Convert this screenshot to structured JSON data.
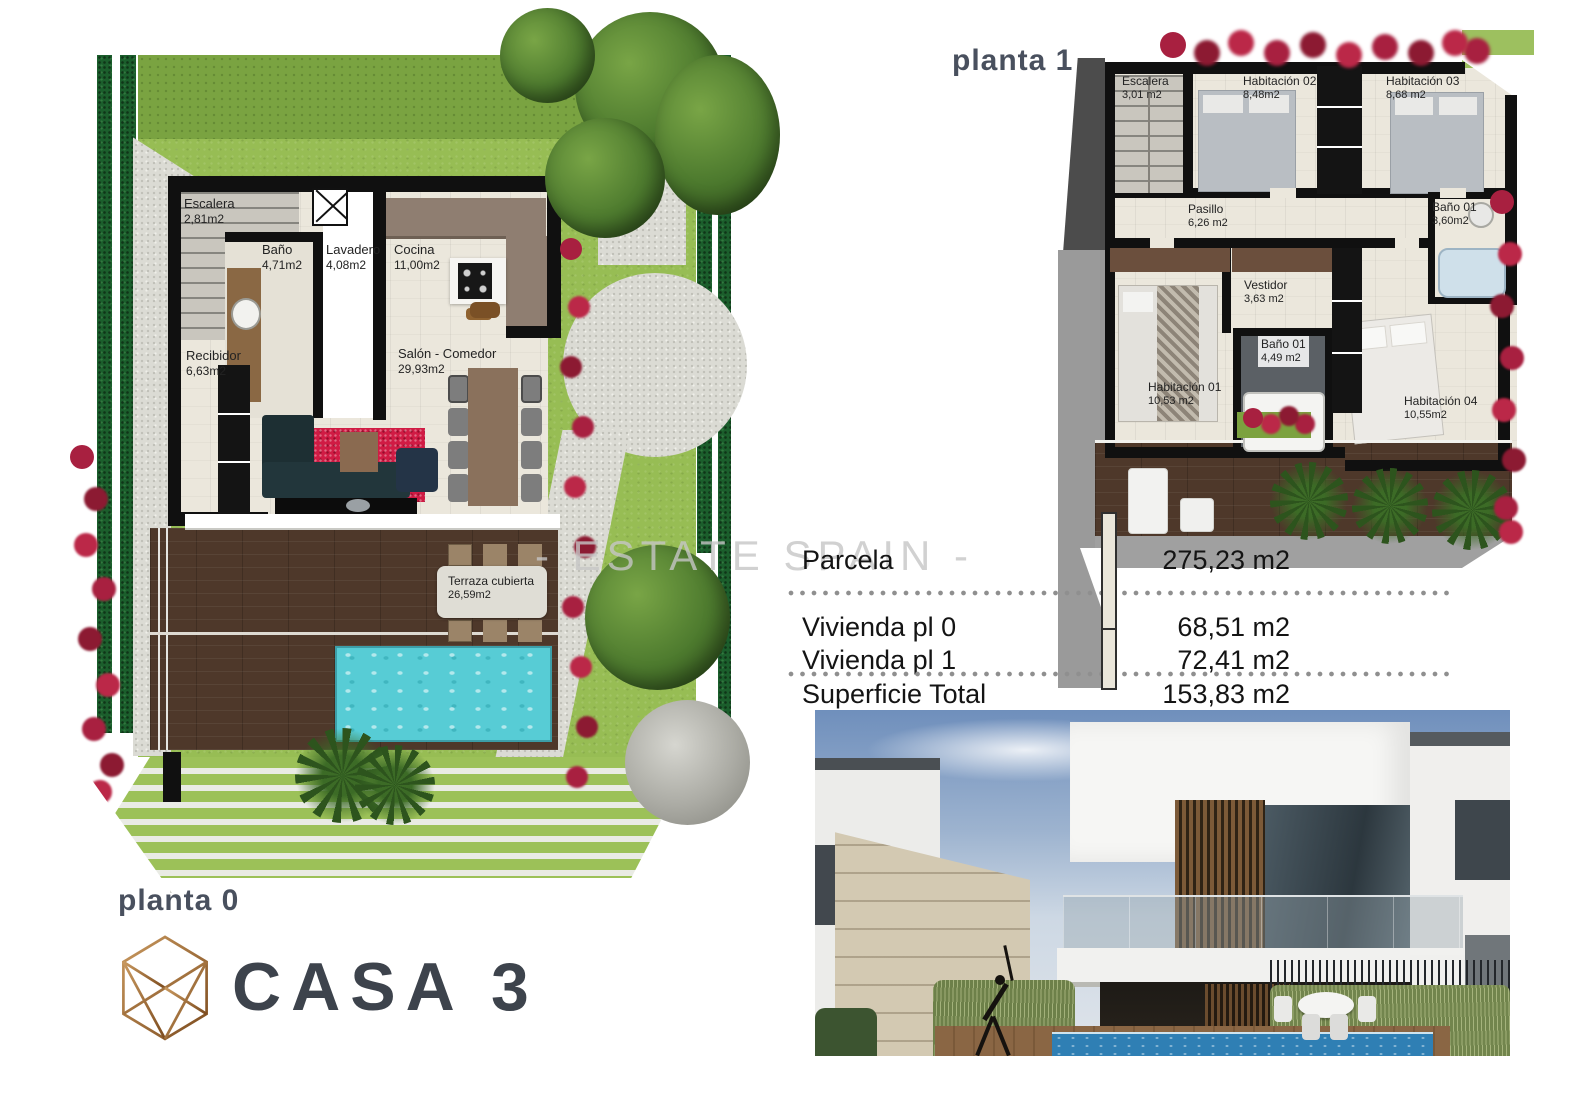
{
  "page": {
    "casa_title": "CASA 3",
    "watermark": "- ESTATE SPAIN -"
  },
  "plans": {
    "planta0": {
      "label": "planta 0",
      "rooms": [
        {
          "name": "Escalera",
          "area": "2,81m2"
        },
        {
          "name": "Baño",
          "area": "4,71m2"
        },
        {
          "name": "Lavadero",
          "area": "4,08m2"
        },
        {
          "name": "Cocina",
          "area": "11,00m2"
        },
        {
          "name": "Recibidor",
          "area": "6,63m2"
        },
        {
          "name": "Salón - Comedor",
          "area": "29,93m2"
        },
        {
          "name": "Terraza cubierta",
          "area": "26,59m2"
        }
      ]
    },
    "planta1": {
      "label": "planta 1",
      "rooms": [
        {
          "name": "Escalera",
          "area": "3,01 m2"
        },
        {
          "name": "Habitación 02",
          "area": "8,48m2"
        },
        {
          "name": "Habitación 03",
          "area": "8,68 m2"
        },
        {
          "name": "Pasillo",
          "area": "6,26 m2"
        },
        {
          "name": "Baño 01",
          "area": "3,60m2"
        },
        {
          "name": "Vestidor",
          "area": "3,63 m2"
        },
        {
          "name": "Baño 01",
          "area": "4,49 m2"
        },
        {
          "name": "Habitación 01",
          "area": "10,53 m2"
        },
        {
          "name": "Habitación 04",
          "area": "10,55m2"
        }
      ]
    }
  },
  "areas_table": {
    "rows": [
      {
        "label": "Parcela",
        "value": "275,23 m2"
      },
      {
        "label": "Vivienda pl 0",
        "value": "68,51 m2"
      },
      {
        "label": "Vivienda pl 1",
        "value": "72,41 m2"
      },
      {
        "label": "Superficie Total",
        "value": "153,83 m2"
      }
    ]
  },
  "colors": {
    "lawn": "#97bd54",
    "hedge": "#1b5e2c",
    "deck_wood": "#4e382a",
    "pool": "#57ccd5",
    "wall": "#101010",
    "bougainvillea": "#a82040",
    "logo_gold": "#b9854a",
    "heading_gray": "#49505e",
    "watermark_gray": "#c6c6c6"
  }
}
